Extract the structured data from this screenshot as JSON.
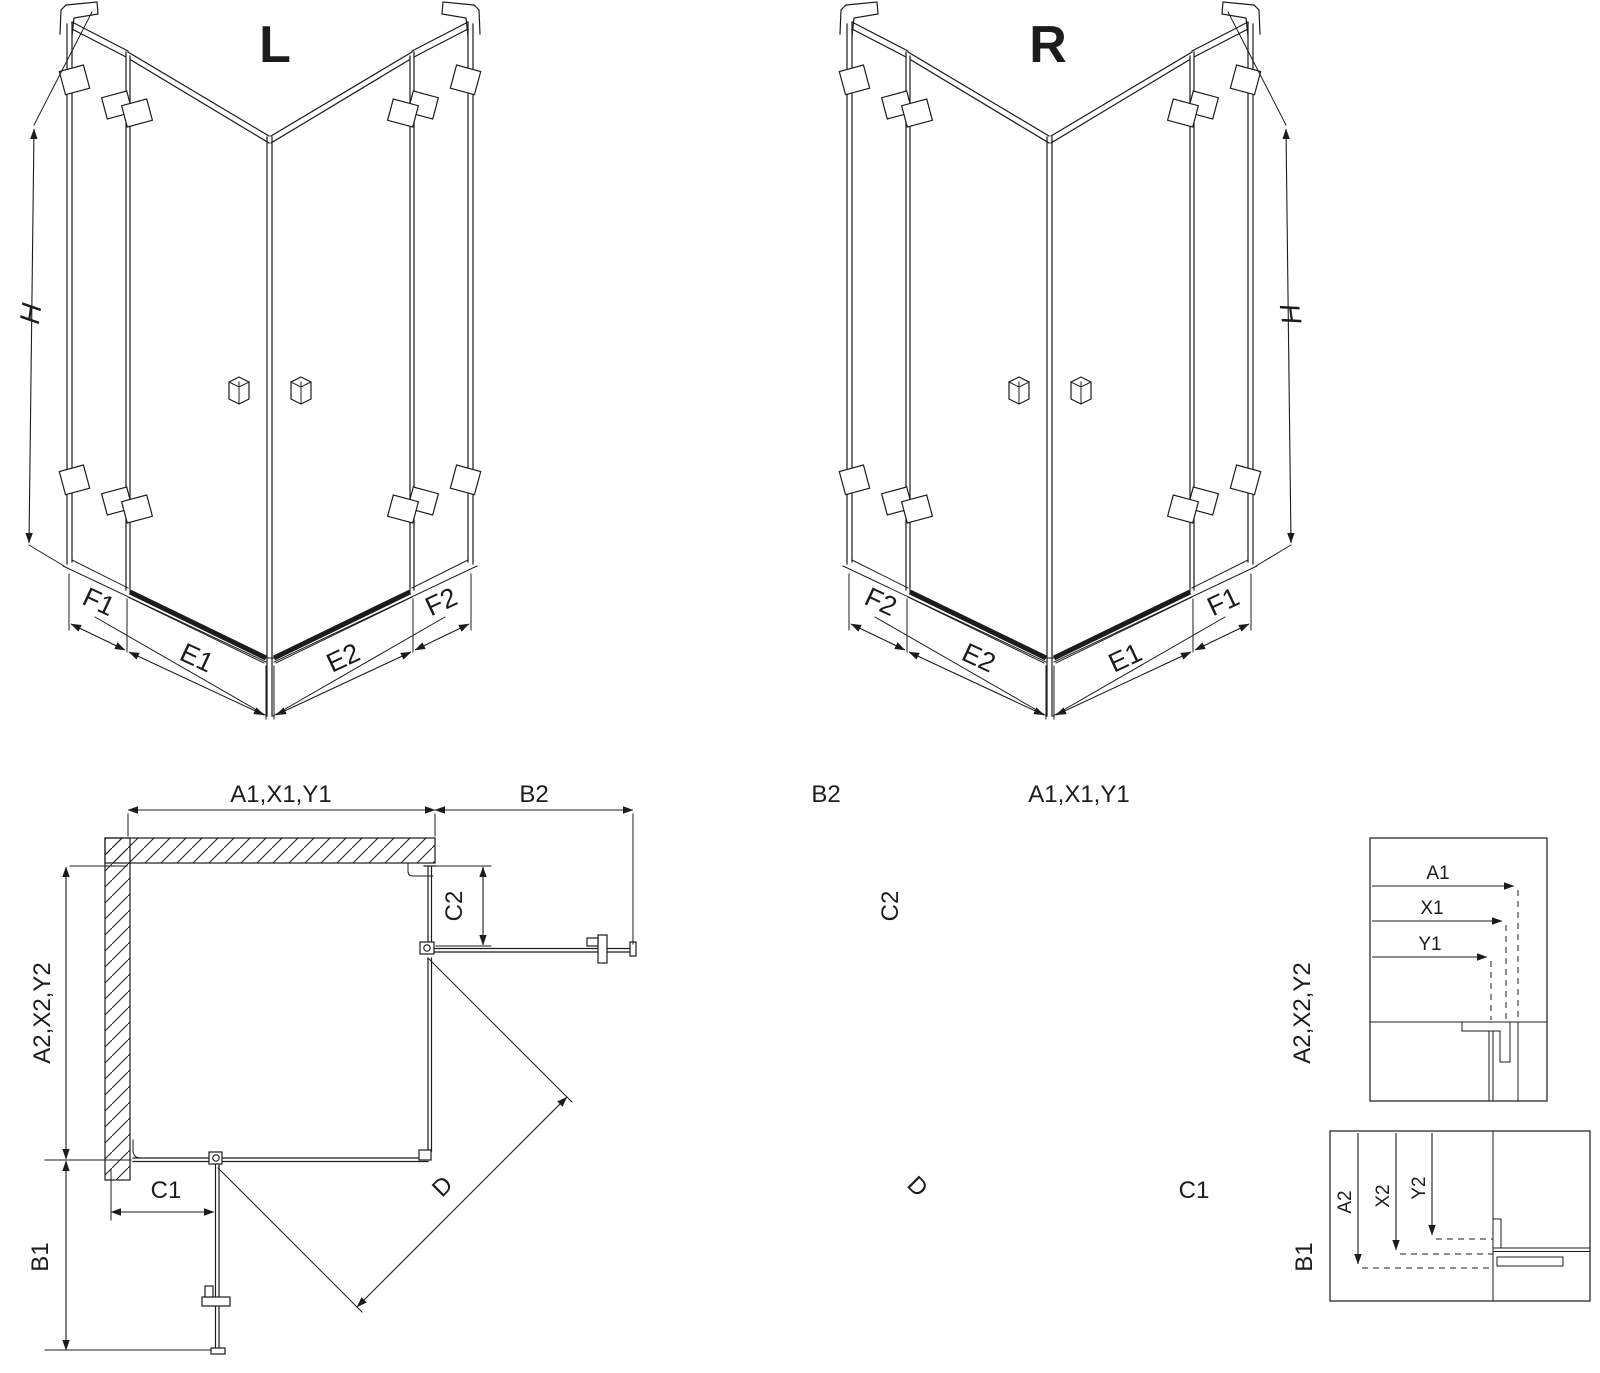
{
  "colors": {
    "line": "#1c1c1c",
    "background": "#ffffff"
  },
  "iso_left": {
    "title": "L",
    "height_label": "H",
    "tray_labels": [
      "F1",
      "E1",
      "E2",
      "F2"
    ]
  },
  "iso_right": {
    "title": "R",
    "height_label": "H",
    "tray_labels": [
      "F2",
      "E2",
      "E1",
      "F1"
    ]
  },
  "plan_left": {
    "top_dim": "A1,X1,Y1",
    "top_right_dim": "B2",
    "fixed_panel_dim": "C2",
    "side_dim": "A2,X2,Y2",
    "bottom_fixed_dim": "C1",
    "bottom_side_dim": "B1",
    "diagonal_dim": "D"
  },
  "plan_right": {
    "top_left_dim": "B2",
    "top_dim": "A1,X1,Y1",
    "fixed_panel_dim": "C2",
    "side_dim": "A2,X2,Y2",
    "bottom_fixed_dim": "C1",
    "bottom_side_dim": "B1",
    "diagonal_dim": "D"
  },
  "detail_upper": {
    "rows": [
      "A1",
      "X1",
      "Y1"
    ]
  },
  "detail_lower": {
    "rows": [
      "A2",
      "X2",
      "Y2"
    ]
  }
}
